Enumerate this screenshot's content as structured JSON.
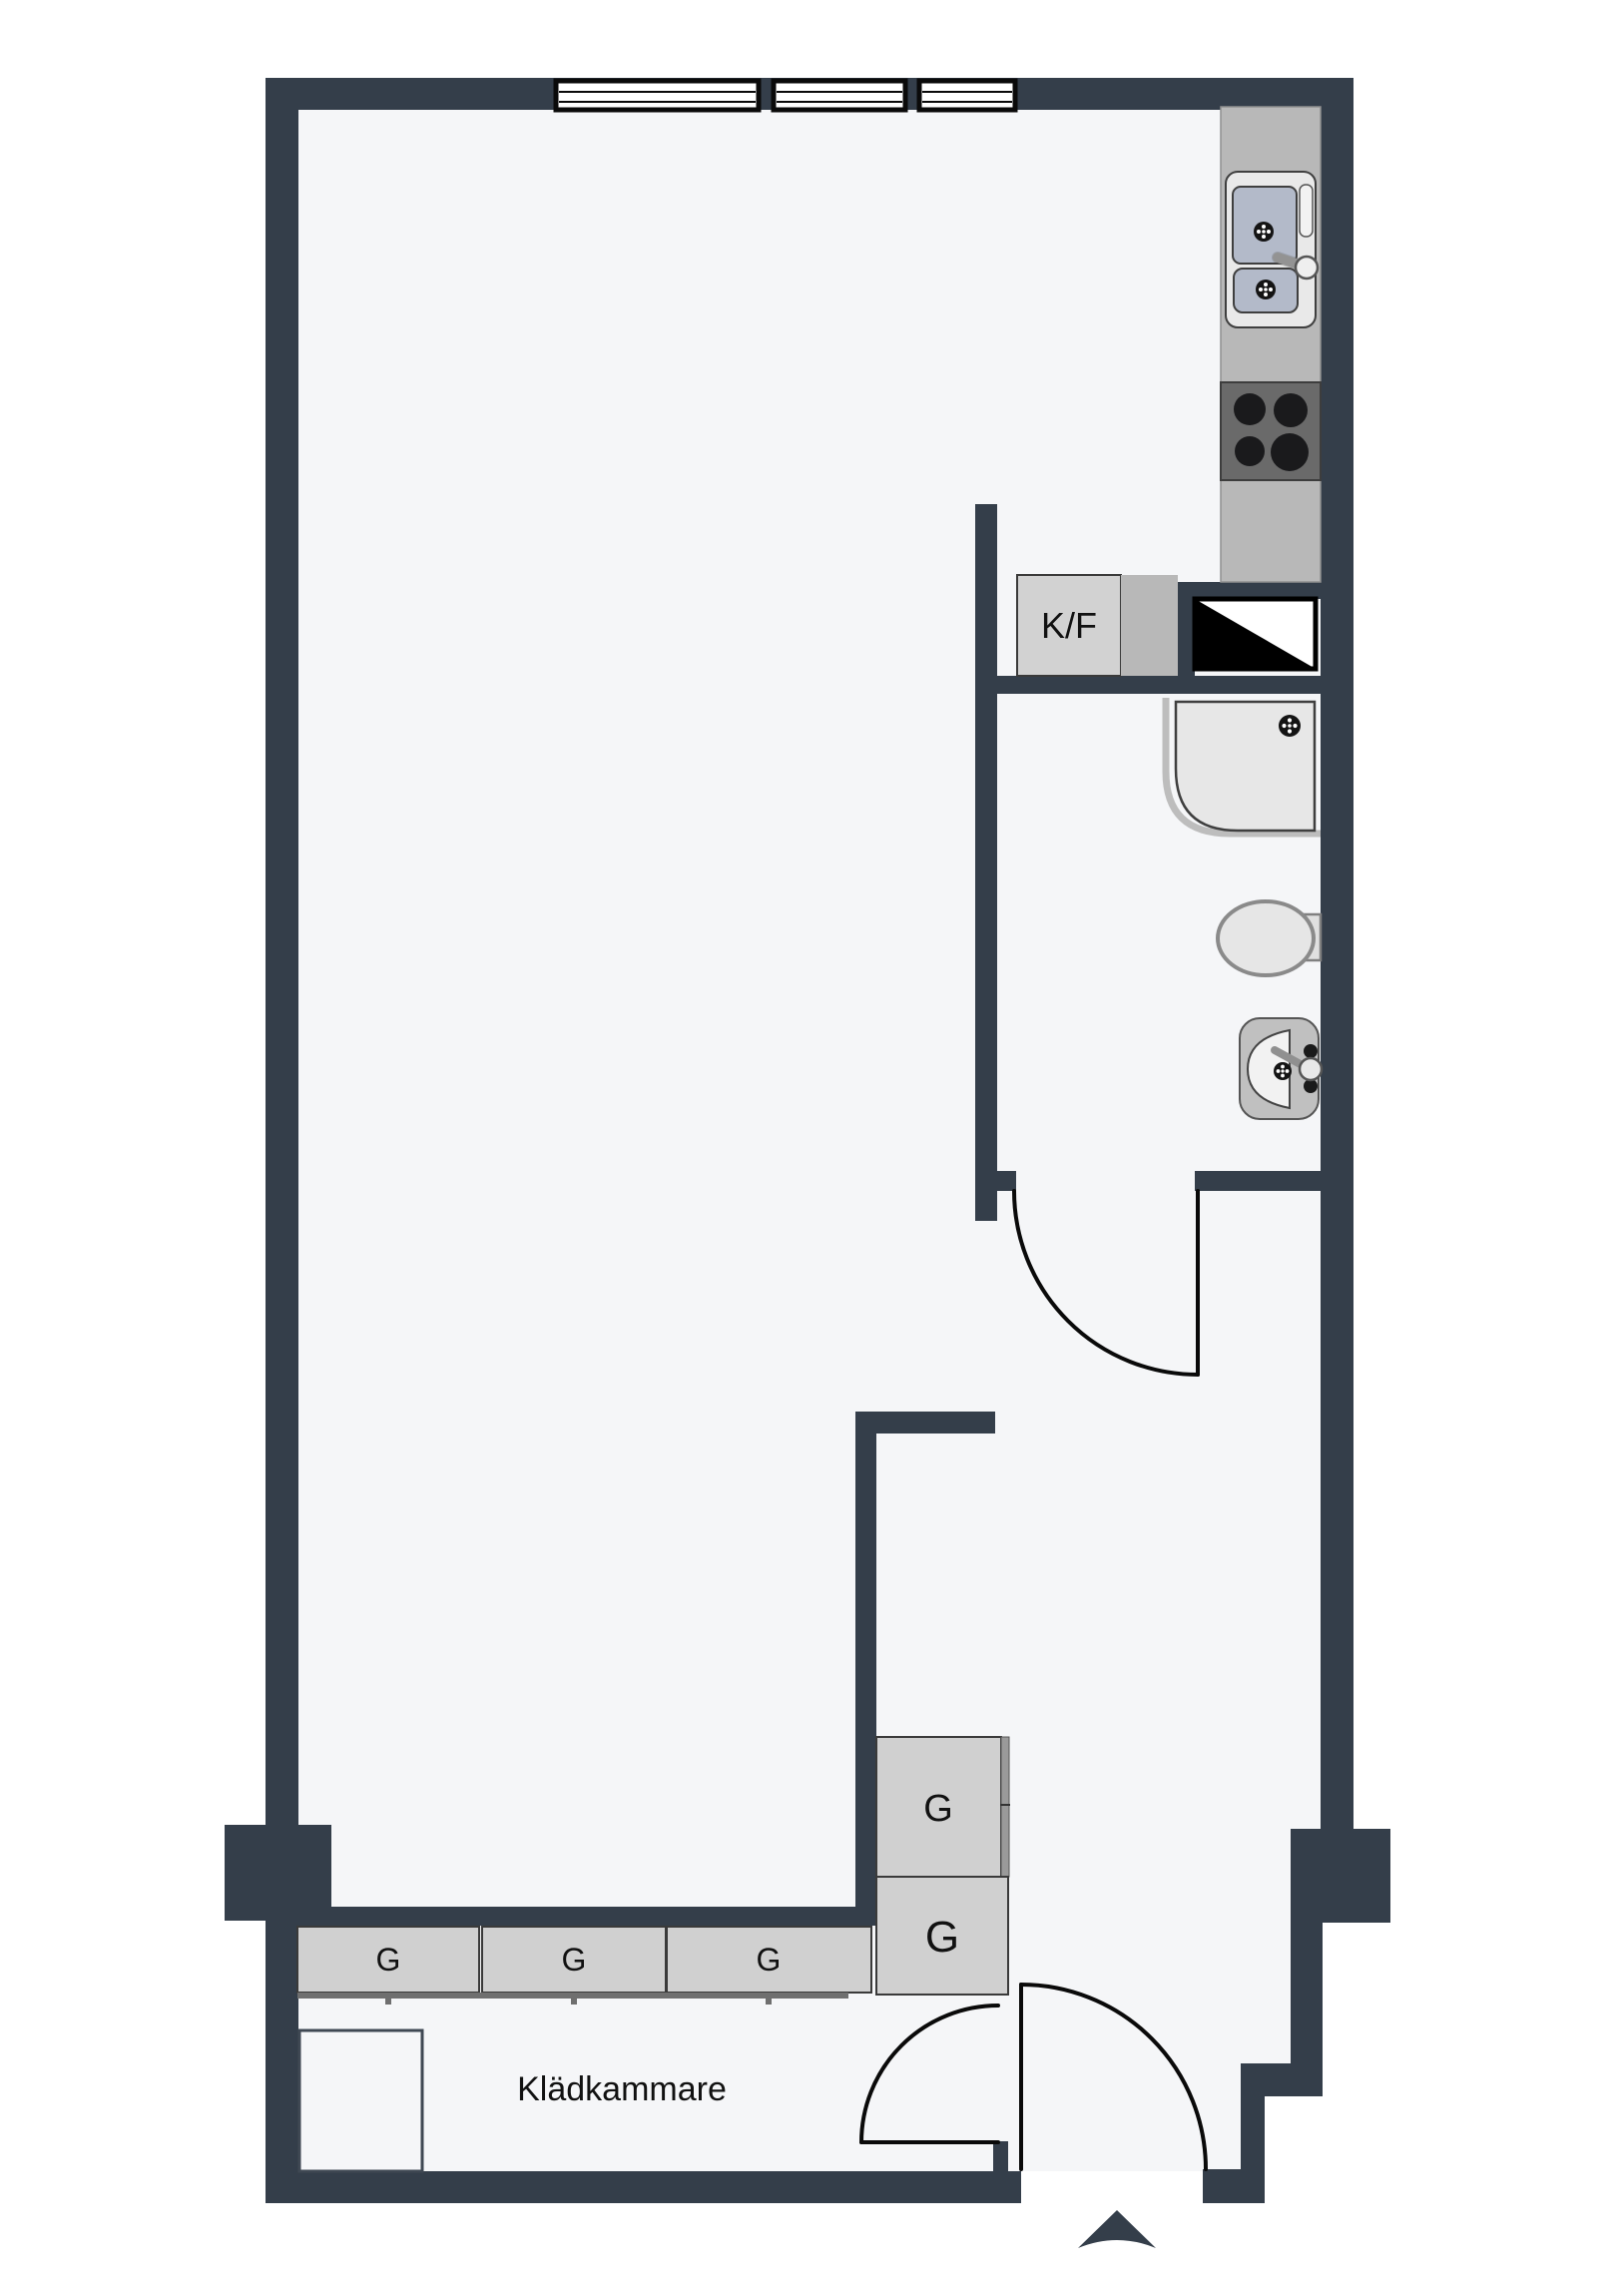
{
  "document": {
    "type": "apartment-floor-plan"
  },
  "labels": {
    "fridge_freezer": "K/F",
    "wardrobe": "G",
    "closet_room": "Klädkammare"
  },
  "fixtures": [
    "kitchen-sink-double-basin",
    "stove-four-burners",
    "fridge-freezer",
    "ventilation-shaft",
    "shower",
    "toilet",
    "bathroom-sink",
    "wardrobes",
    "entrance-arrow"
  ],
  "colors": {
    "wall": "#343e4a",
    "floor": "#f5f6f8",
    "outline": "#0a0a0a",
    "counter": "#b8b8b8",
    "stove": "#6a6a6a",
    "burner": "#1a1a1c",
    "appliance": "#e9e9e9",
    "basin": "#b3bac9",
    "cabinet": "#d2d2d2",
    "wardrobe": "#d0d0d0",
    "fixture": "#e7e7e7"
  }
}
